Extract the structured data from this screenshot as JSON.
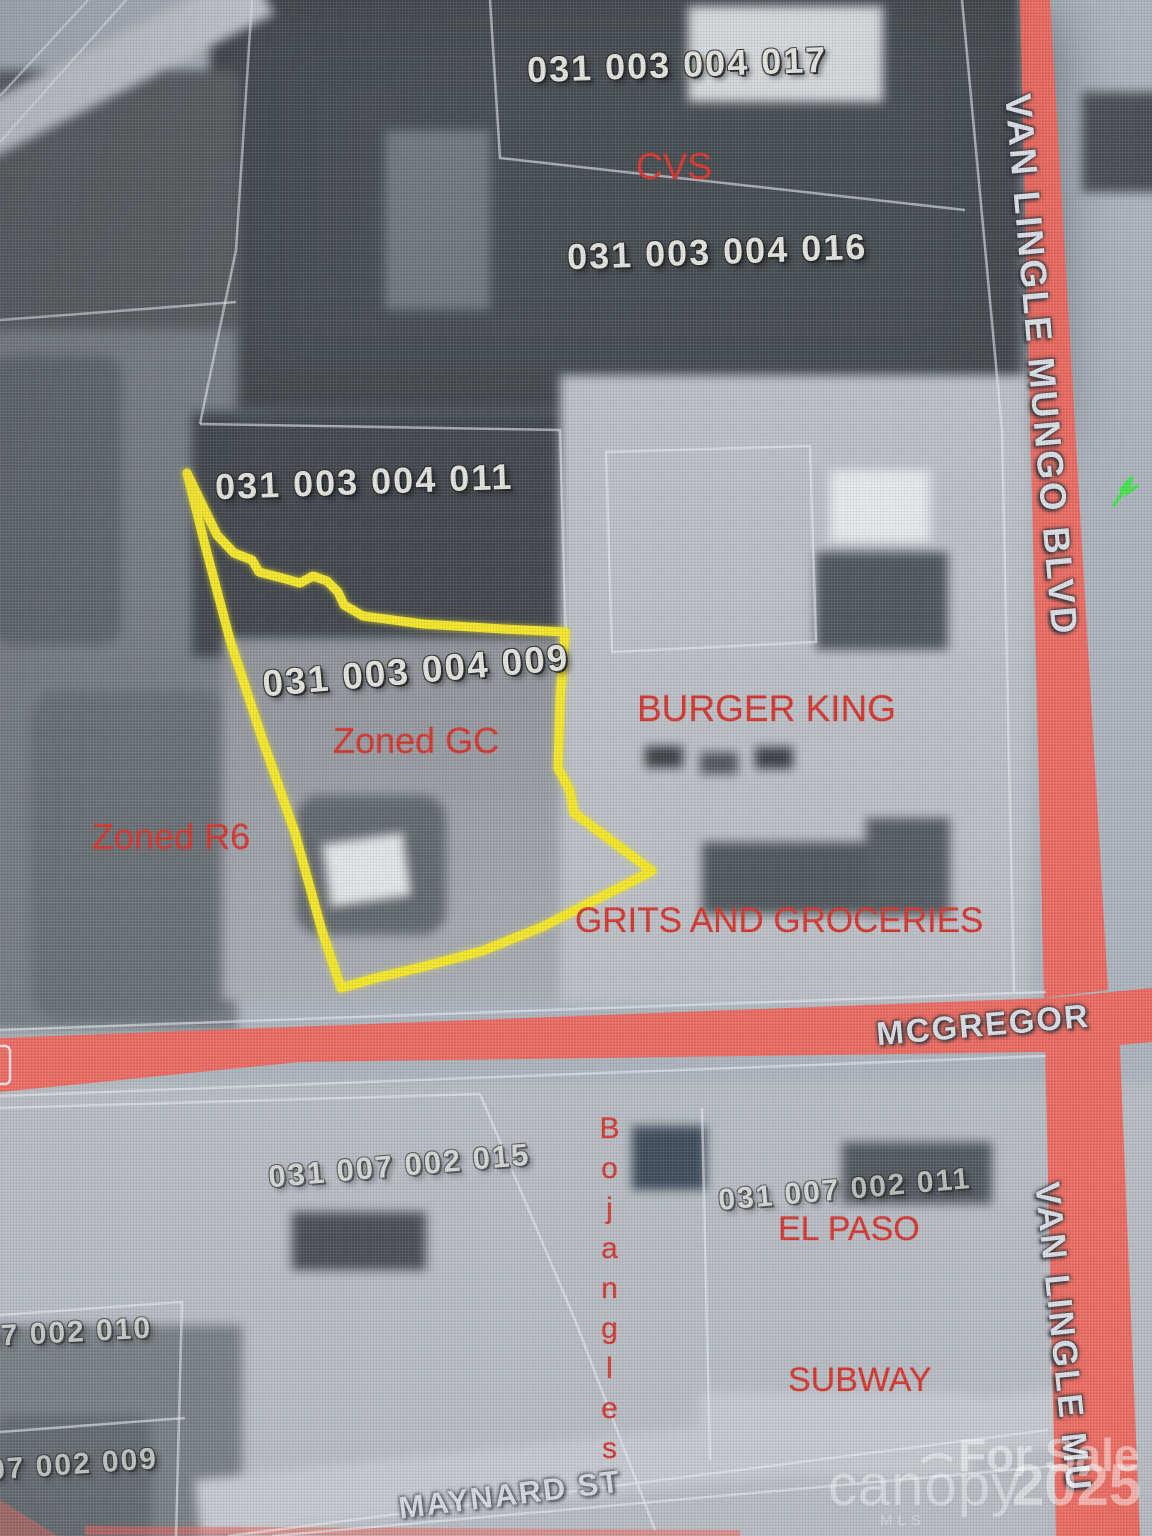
{
  "map": {
    "parcels": {
      "p017": "031 003 004 017",
      "p016": "031 003 004 016",
      "p011": "031 003 004 011",
      "p009": "031 003 004 009",
      "p015": "031 007 002 015",
      "p011b": "031 007 002 011",
      "p010_partial": "07 002 010",
      "p009_partial": "07 002 009"
    },
    "businesses": {
      "cvs": "CVS",
      "burger_king": "BURGER KING",
      "grits": "GRITS AND GROCERIES",
      "bojangles": "Bojangles",
      "el_paso": "EL PASO",
      "subway": "SUBWAY"
    },
    "zoning": {
      "gc": "Zoned GC",
      "r6": "Zoned R6"
    },
    "streets": {
      "van_lingle_top": "VAN LINGLE MUNGO BLVD",
      "van_lingle_bottom": "VAN LINGLE MU",
      "mcgregor": "MCGREGOR",
      "maynard": "MAYNARD ST"
    },
    "watermark": {
      "for_sale": "For Sale",
      "brand": "canopy",
      "brand_sub": "MLS",
      "year": "2025"
    },
    "colors": {
      "annotation_red": "#d02820",
      "parcel_outline_yellow": "#f2e41c",
      "road_red": "#ee5a4e",
      "cursor_green": "#35e23c",
      "boundary_white": "rgba(228,233,240,0.6)"
    }
  }
}
